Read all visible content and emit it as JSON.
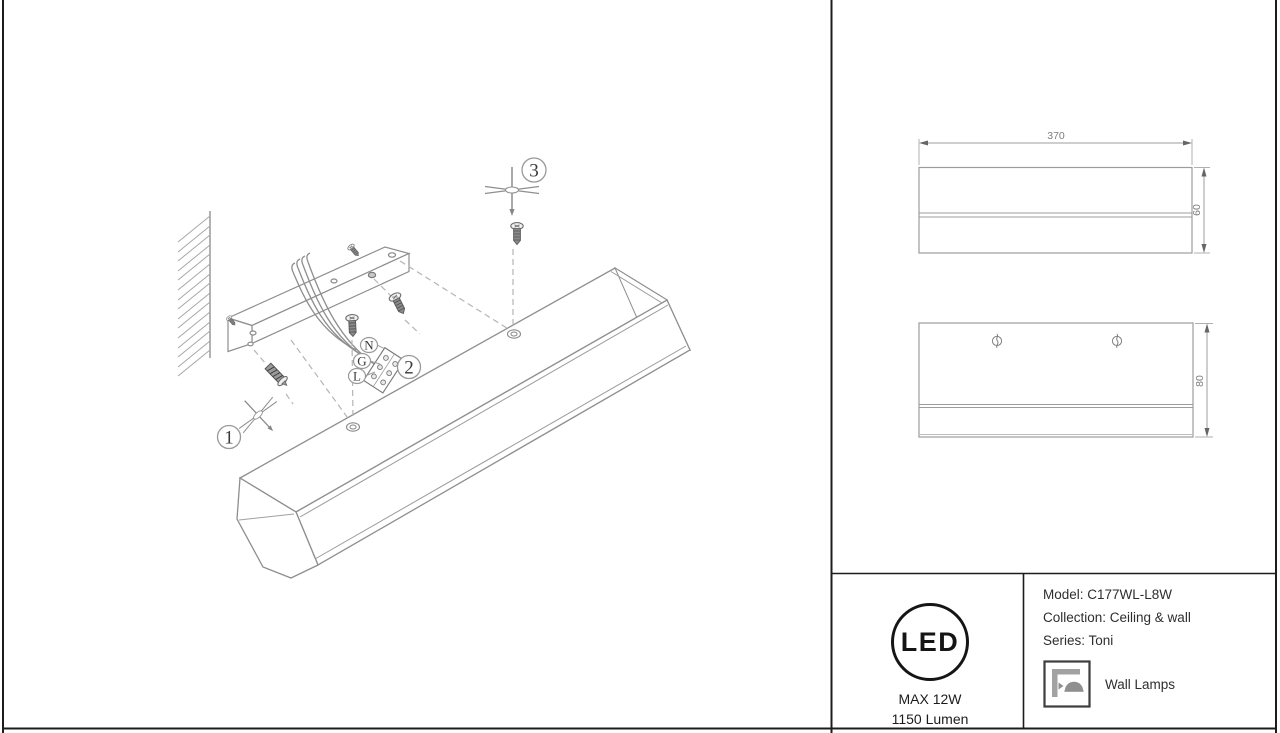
{
  "assembly_diagram": {
    "callout_1": "1",
    "callout_2": "2",
    "callout_3": "3",
    "wire_label_n": "N",
    "wire_label_g": "G",
    "wire_label_l": "L"
  },
  "dimension_views": {
    "front_view": {
      "width_mm": "370",
      "height_mm": "60"
    },
    "back_view": {
      "height_mm": "80"
    }
  },
  "info_panel": {
    "led_badge": {
      "logo": "LED",
      "max_power": "MAX 12W",
      "luminous_flux": "1150 Lumen"
    },
    "product": {
      "model": "Model: C177WL-L8W",
      "collection": "Collection: Ceiling & wall",
      "series": "Series: Toni",
      "category": "Wall Lamps"
    }
  }
}
